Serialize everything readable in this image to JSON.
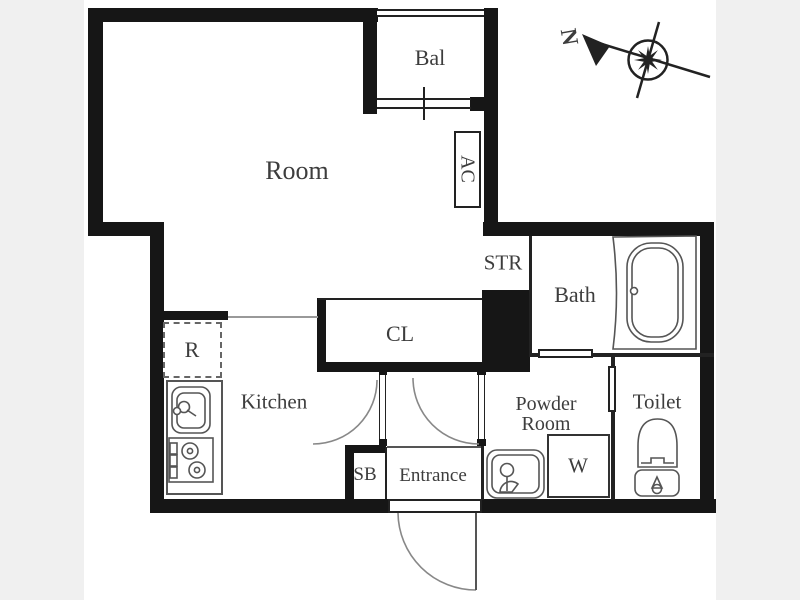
{
  "plan": {
    "title": "studio-apartment-floor-plan",
    "labels": {
      "room": "Room",
      "balcony": "Bal",
      "air_conditioner": "AC",
      "storage": "STR",
      "bath": "Bath",
      "closet": "CL",
      "kitchen": "Kitchen",
      "refrigerator": "R",
      "shoe_box": "SB",
      "entrance": "Entrance",
      "powder_room_line1": "Powder",
      "powder_room_line2": "Room",
      "washing_machine": "W",
      "toilet": "Toilet"
    },
    "compass": {
      "north": "N"
    },
    "icons": [
      "bathtub-icon",
      "kitchen-sink-icon",
      "stove-icon",
      "washbasin-icon",
      "toilet-icon",
      "washing-machine-box",
      "compass-icon",
      "door-swing-arc",
      "sliding-door",
      "window"
    ],
    "colors": {
      "wall": "#161616",
      "paper": "#ffffff",
      "margin_background": "#f0f0f0",
      "text": "#3d3d3d",
      "fixture_line": "#555555"
    }
  }
}
